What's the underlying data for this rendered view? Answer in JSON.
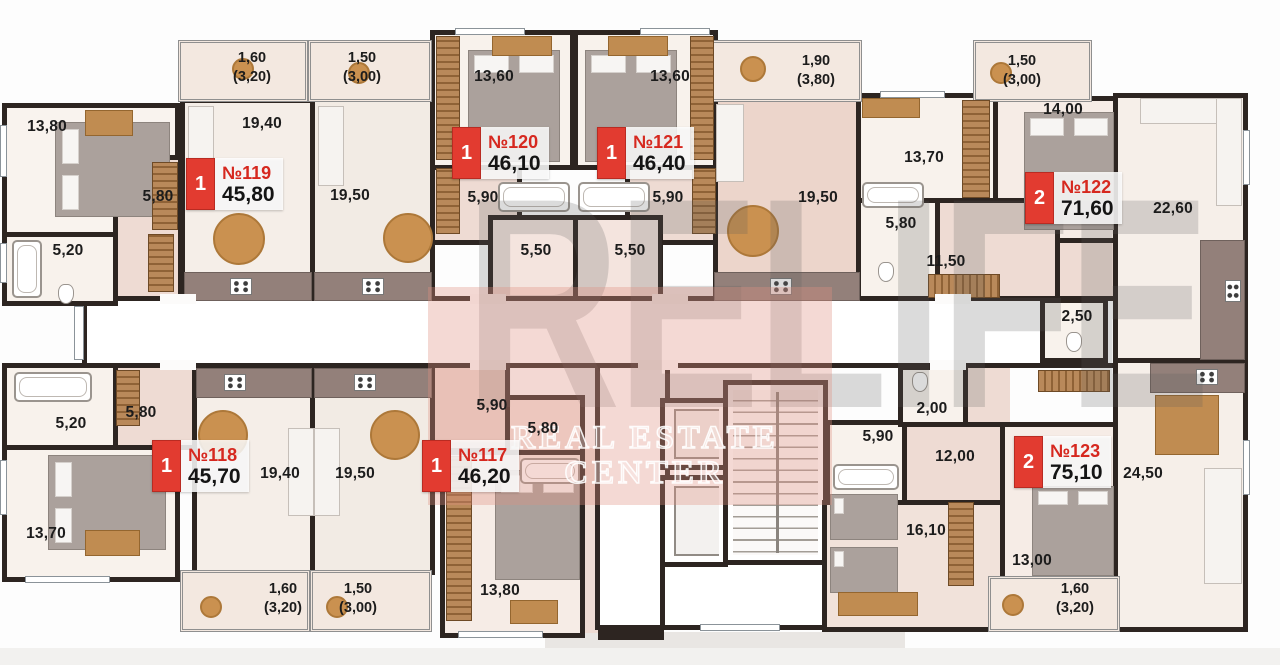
{
  "watermark": {
    "brand": "RELIFE",
    "sub1": "REAL ESTATE",
    "sub2": "CENTER"
  },
  "units": [
    {
      "label": "№119",
      "area": "45,80",
      "badge": "1"
    },
    {
      "label": "№120",
      "area": "46,10",
      "badge": "1"
    },
    {
      "label": "№121",
      "area": "46,40",
      "badge": "1"
    },
    {
      "label": "№122",
      "area": "71,60",
      "badge": "2"
    },
    {
      "label": "№118",
      "area": "45,70",
      "badge": "1"
    },
    {
      "label": "№117",
      "area": "46,20",
      "badge": "1"
    },
    {
      "label": "№123",
      "area": "75,10",
      "badge": "2"
    }
  ],
  "dims": [
    "13,80",
    "19,40",
    "5,80",
    "5,20",
    "19,50",
    "13,60",
    "5,90",
    "5,50",
    "13,60",
    "5,90",
    "5,50",
    "19,50",
    "13,70",
    "5,80",
    "11,50",
    "14,00",
    "22,60",
    "2,50",
    "5,20",
    "5,80",
    "13,70",
    "19,40",
    "19,50",
    "5,90",
    "5,80",
    "13,80",
    "2,00",
    "5,90",
    "12,00",
    "16,10",
    "13,00",
    "24,50"
  ],
  "balconies": [
    {
      "a": "1,60",
      "b": "(3,20)"
    },
    {
      "a": "1,50",
      "b": "(3,00)"
    },
    {
      "a": "1,90",
      "b": "(3,80)"
    },
    {
      "a": "1,50",
      "b": "(3,00)"
    },
    {
      "a": "1,60",
      "b": "(3,20)"
    },
    {
      "a": "1,50",
      "b": "(3,00)"
    },
    {
      "a": "1,60",
      "b": "(3,20)"
    }
  ],
  "colors": {
    "badge_red": "#e23b30",
    "unit_number_red": "#d6281f",
    "wall_dark": "#2d2521",
    "watermark_band": "#df8f82",
    "floor_pink": "#eedbd3",
    "kitchen_dark": "#93807a"
  }
}
